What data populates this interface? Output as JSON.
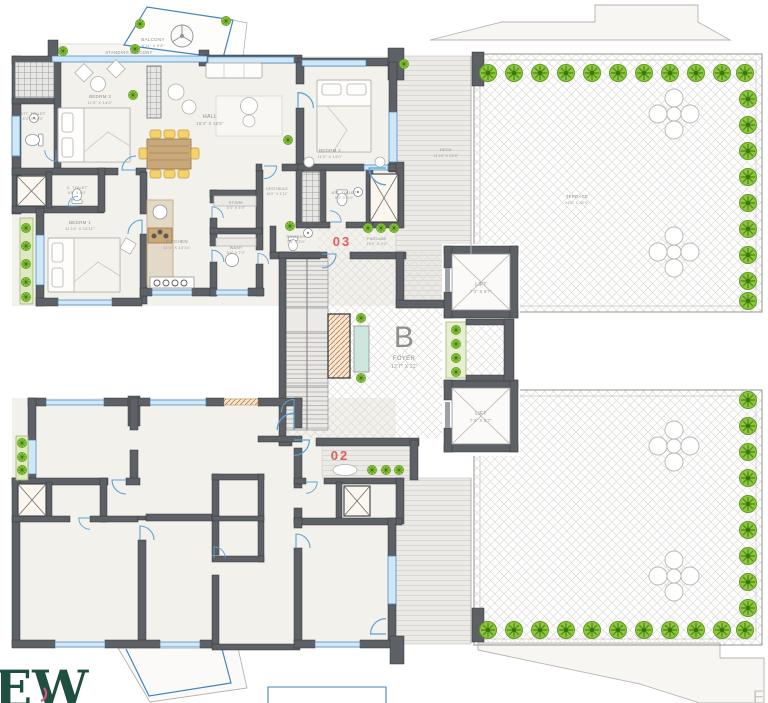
{
  "page": {
    "description": "Architectural floor plan - wing B, flats 02 and 03 with decks and terraces"
  },
  "units": {
    "u03": {
      "number": "03",
      "rooms": {
        "standing_balcony": {
          "name": "STANDING BALCONY"
        },
        "balcony": {
          "name": "BALCONY",
          "dims": "8'11\" X 9'8\""
        },
        "bedroom3": {
          "name": "BEDRM 3",
          "dims": "11'0\" X 14'0\""
        },
        "att_toilet3": {
          "name": "ATT. TOILET",
          "dims": "5'4\" X 14'0\""
        },
        "hall": {
          "name": "HALL",
          "dims": "16'4\" X 15'5\""
        },
        "bedroom2": {
          "name": "BEDRM 2",
          "dims": "11'0\" X 14'0\""
        },
        "att_toilet2": {
          "name": "ATT. TOILET",
          "dims": "9'0\" X 5'0\""
        },
        "c_toilet": {
          "name": "C. TOILET",
          "dims": "5'5\" X 4'0\""
        },
        "bedroom1": {
          "name": "BEDRM 1",
          "dims": "11'10\" X 13'11\""
        },
        "kitchen": {
          "name": "KITCHEN",
          "dims": "11'1\" X 13'10\""
        },
        "store": {
          "name": "STORE",
          "dims": "5'3\" X 4'0\""
        },
        "wash": {
          "name": "WASH",
          "dims": "5'4\" X 7'0\""
        },
        "vestibule": {
          "name": "VESTIBULE",
          "dims": "16'0\" X 4'11\""
        },
        "powder": {
          "name": "POWDER",
          "dims": "7'6\" X 5'0\""
        },
        "passage": {
          "name": "PASSAGE",
          "dims": "10'6\" X 5'0\""
        }
      }
    },
    "u02": {
      "number": "02"
    }
  },
  "core": {
    "block_letter": "B",
    "foyer": {
      "name": "FOYER",
      "dims": "12'7\" X 22'"
    },
    "lift_upper": {
      "name": "LIFT",
      "dims": "7'4\" X 6'7\""
    },
    "lift_lower": {
      "name": "LIFT",
      "dims": "7'4\" X 6'7\""
    }
  },
  "outdoor": {
    "deck": {
      "name": "DECK",
      "dims": "11'10\" X 23'8\""
    },
    "terrace": {
      "name": "TERRACE",
      "dims": "34'6\" X 40'0\""
    }
  },
  "watermark": {
    "logo_text": "EW",
    "corner_letter": "F"
  },
  "colors": {
    "unit_number_red": "#e05c5c",
    "wall_gray": "#5d6165",
    "window_blue": "#3f84bf",
    "shrub_green": "#8dc63f",
    "label_gray": "#8f8e89",
    "watermark_green": "#1e4f41",
    "watermark_pink": "#e0557d"
  }
}
